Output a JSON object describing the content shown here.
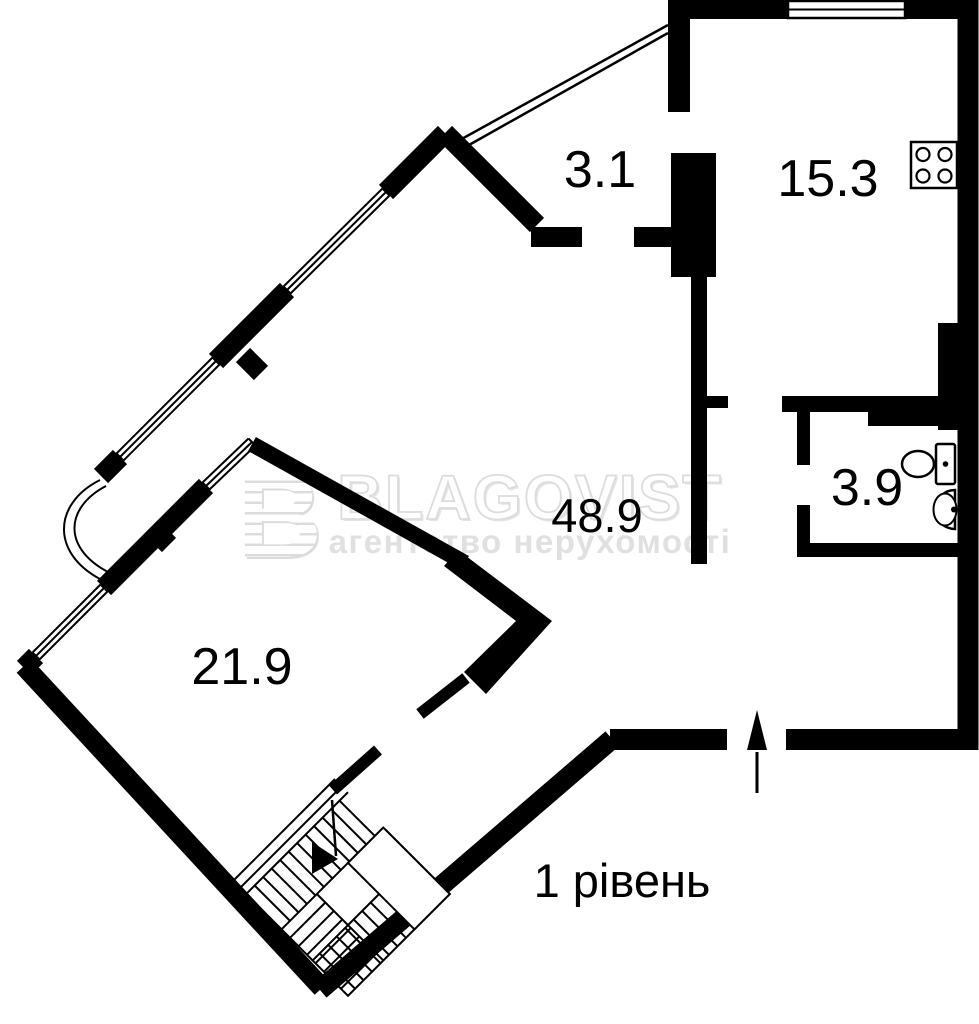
{
  "plan": {
    "level_label": "1 рівень",
    "rooms": {
      "hallway": {
        "area": "3.1"
      },
      "kitchen": {
        "area": "15.3"
      },
      "living": {
        "area": "48.9"
      },
      "bathroom": {
        "area": "3.9"
      },
      "bedroom": {
        "area": "21.9"
      }
    },
    "fixtures": [
      "stove",
      "toilet",
      "sink",
      "staircase",
      "stair-direction-arrow",
      "entrance-arrow"
    ],
    "colors": {
      "walls": "#000000",
      "background": "#ffffff",
      "watermark": "#e0e0e0"
    }
  },
  "watermark": {
    "logo": "B",
    "brand": "BLAGOVIST",
    "tagline": "агентство нерухомості"
  }
}
